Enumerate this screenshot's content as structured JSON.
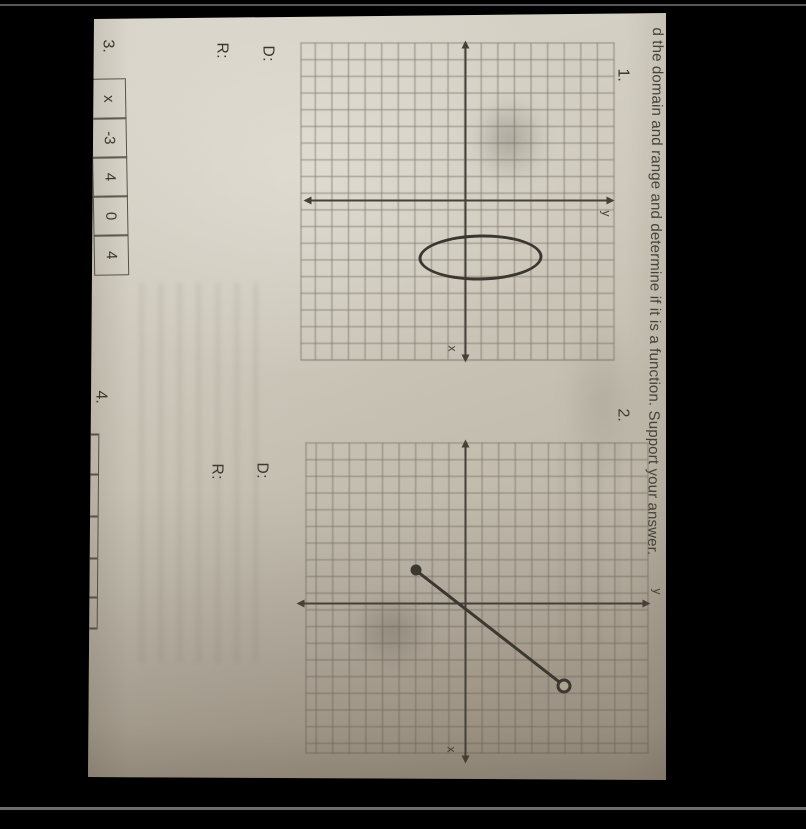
{
  "heading": {
    "text": "d the domain and range and determine if it is a function. Support your answer."
  },
  "problem1": {
    "number": "1.",
    "domain_label": "D:",
    "range_label": "R:",
    "x_axis_label": "x",
    "y_axis_label": "y"
  },
  "problem2": {
    "number": "2.",
    "domain_label": "D:",
    "range_label": "R:",
    "x_axis_label": "x",
    "y_axis_label": "y"
  },
  "problem3": {
    "number": "3.",
    "table": {
      "row_header": "x",
      "values": [
        "-3",
        "4",
        "0",
        "4"
      ]
    }
  },
  "problem4": {
    "number": "4."
  },
  "chart_data": [
    {
      "type": "scatter",
      "title": "Problem 1 graph",
      "shape": "ellipse",
      "center": [
        3.5,
        1
      ],
      "rx": 1.4,
      "ry": 3.7,
      "xlabel": "x",
      "ylabel": "y",
      "grid": "on",
      "grid_cells": 19,
      "xlim": [
        -10,
        9
      ],
      "ylim": [
        -10,
        9
      ]
    },
    {
      "type": "line",
      "title": "Problem 2 graph",
      "shape": "segment",
      "closed_endpoint": [
        -2,
        -3
      ],
      "open_endpoint": [
        5,
        6
      ],
      "xlabel": "x",
      "ylabel": "y",
      "grid": "on",
      "grid_cells": 19,
      "xlim": [
        -10,
        9
      ],
      "ylim": [
        -10,
        9
      ]
    },
    {
      "type": "table",
      "title": "Problem 3 table",
      "columns": [
        "x",
        "-3",
        "4",
        "0",
        "4"
      ]
    }
  ],
  "colors": {
    "background": "#000000",
    "paper": "#c9c4b7",
    "ink": "#3b3730",
    "axis": "#45413a",
    "grid_line": "#6e6858",
    "frame_line": "#5e5e5e"
  }
}
